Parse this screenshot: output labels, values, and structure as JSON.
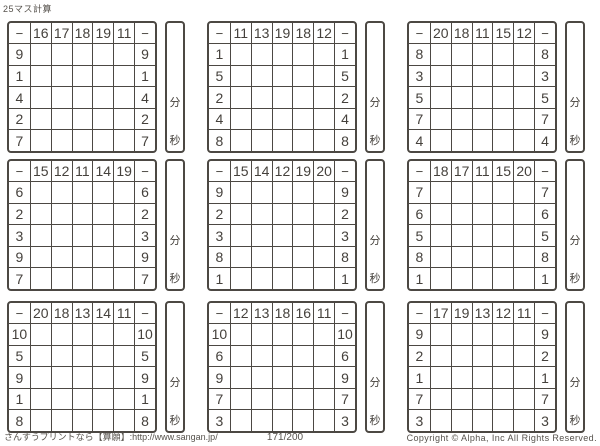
{
  "title": "25マス計算",
  "operator": "−",
  "timer": {
    "minutes": "分",
    "seconds": "秒"
  },
  "grids": [
    {
      "cols": [
        "16",
        "17",
        "18",
        "19",
        "11"
      ],
      "rows": [
        "9",
        "1",
        "4",
        "2",
        "7"
      ]
    },
    {
      "cols": [
        "11",
        "13",
        "19",
        "18",
        "12"
      ],
      "rows": [
        "1",
        "5",
        "2",
        "4",
        "8"
      ]
    },
    {
      "cols": [
        "20",
        "18",
        "11",
        "15",
        "12"
      ],
      "rows": [
        "8",
        "3",
        "5",
        "7",
        "4"
      ]
    },
    {
      "cols": [
        "15",
        "12",
        "11",
        "14",
        "19"
      ],
      "rows": [
        "6",
        "2",
        "3",
        "9",
        "7"
      ]
    },
    {
      "cols": [
        "15",
        "14",
        "12",
        "19",
        "20"
      ],
      "rows": [
        "9",
        "2",
        "3",
        "8",
        "1"
      ]
    },
    {
      "cols": [
        "18",
        "17",
        "11",
        "15",
        "20"
      ],
      "rows": [
        "7",
        "6",
        "5",
        "8",
        "1"
      ]
    },
    {
      "cols": [
        "20",
        "18",
        "13",
        "14",
        "11"
      ],
      "rows": [
        "10",
        "5",
        "9",
        "1",
        "8"
      ]
    },
    {
      "cols": [
        "12",
        "13",
        "18",
        "16",
        "11"
      ],
      "rows": [
        "10",
        "6",
        "9",
        "7",
        "3"
      ]
    },
    {
      "cols": [
        "17",
        "19",
        "13",
        "12",
        "11"
      ],
      "rows": [
        "9",
        "2",
        "1",
        "7",
        "3"
      ]
    }
  ],
  "footer": {
    "site": "さんすうプリントなら【算願】:http://www.sangan.jp/",
    "page": "171/200",
    "copyright": "Copyright © Alpha, Inc All Rights Reserved."
  }
}
